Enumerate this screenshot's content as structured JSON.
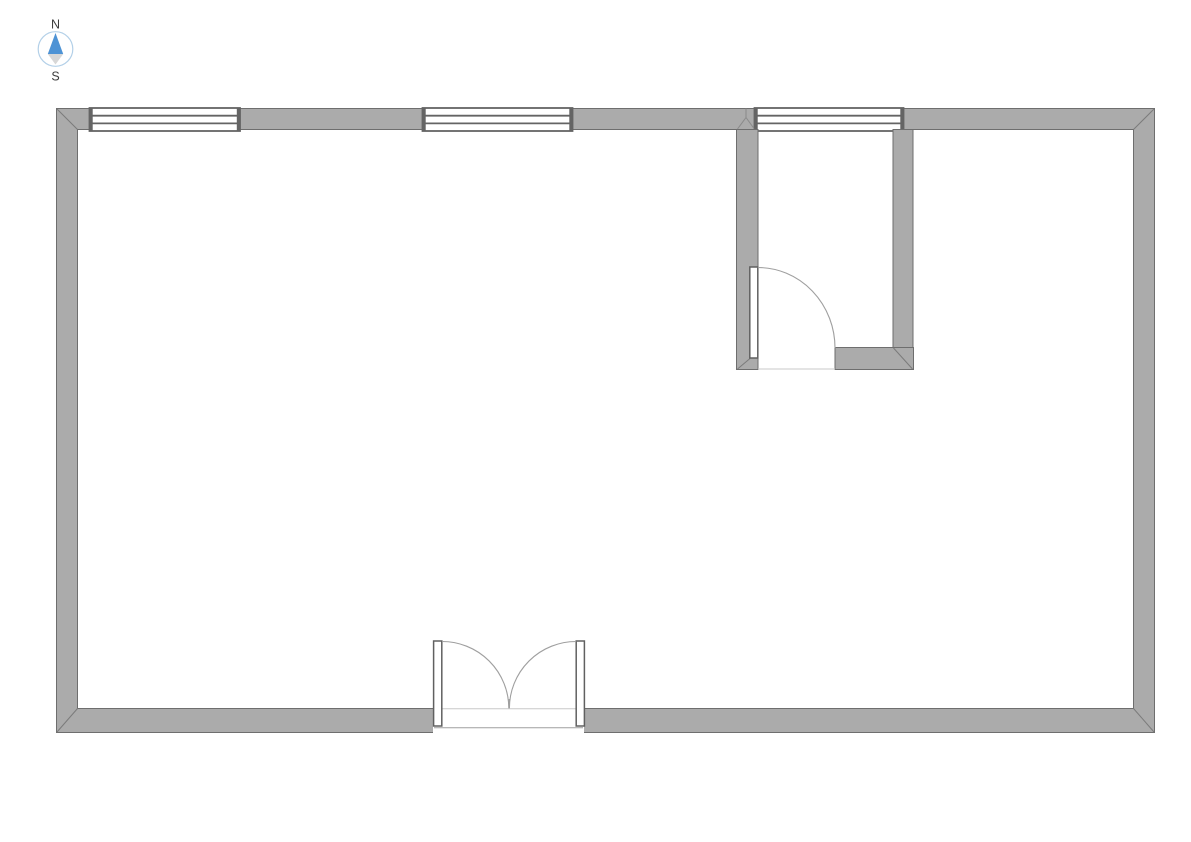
{
  "page": {
    "type": "floor-plan-view",
    "background": "#ffffff"
  },
  "compass": {
    "north_label": "N",
    "south_label": "S"
  },
  "palette": {
    "wall_fill": "#ababab",
    "wall_outline": "#6e6e6e",
    "corner_miter": "#7b7b7b",
    "window_frame": "#646464",
    "door_outline": "#606060",
    "swing_arc": "#9f9f9f",
    "threshold_line": "#c8c8c8",
    "compass_ring": "#b3d0e8",
    "compass_north": "#4e93d5",
    "compass_south": "#d7d7d7",
    "compass_text": "#3c3c3c"
  },
  "plan": {
    "outer_walls": {
      "x": 56,
      "y": 108,
      "width": 1099,
      "height": 625,
      "thickness": 22
    },
    "windows": [
      {
        "id": "window-1",
        "wall": "north",
        "x": 90,
        "width": 150,
        "panes": 3
      },
      {
        "id": "window-2",
        "wall": "north",
        "x": 423,
        "width": 150,
        "panes": 3
      },
      {
        "id": "window-3",
        "wall": "north",
        "x": 755,
        "width": 149,
        "panes": 3
      }
    ],
    "doors": [
      {
        "id": "double-door-south",
        "type": "double-swing",
        "wall": "south",
        "x": 433,
        "opening_width": 151,
        "swing": "inward"
      },
      {
        "id": "interior-room-door",
        "type": "single-swing",
        "location": "interior-room-south-west",
        "opening_width": 77,
        "swing": "into-room"
      }
    ],
    "rooms": [
      {
        "id": "main-room",
        "description": "large open room spanning full plan"
      },
      {
        "id": "interior-room",
        "position": "top-right",
        "x": 737,
        "y": 130,
        "width": 176,
        "height": 240
      }
    ]
  }
}
